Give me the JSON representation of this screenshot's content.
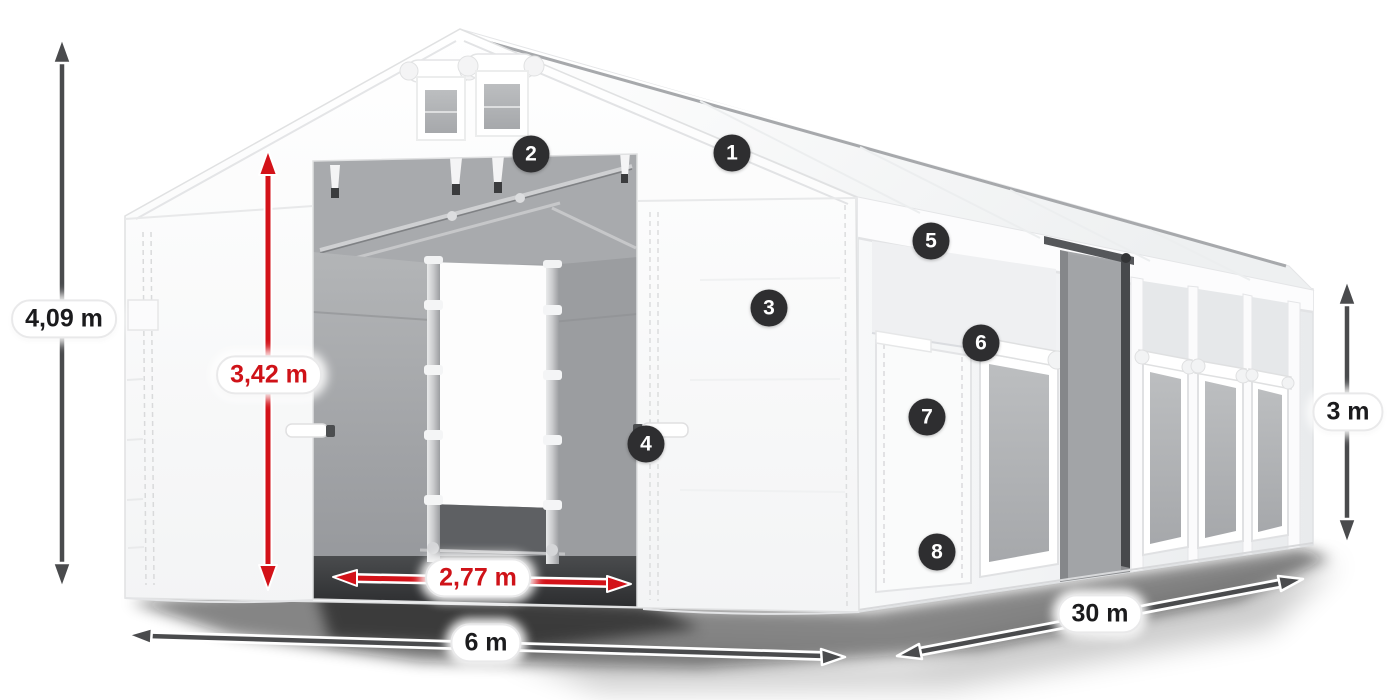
{
  "figure": {
    "kind": "product-dimension-diagram"
  },
  "dimensions": {
    "total_height": "4,09 m",
    "entrance_height": "3,42 m",
    "entrance_width": "2,77 m",
    "front_width": "6 m",
    "side_length": "30 m",
    "side_wall_height": "3 m"
  },
  "hotspots": [
    {
      "label": "1"
    },
    {
      "label": "2"
    },
    {
      "label": "3"
    },
    {
      "label": "4"
    },
    {
      "label": "5"
    },
    {
      "label": "6"
    },
    {
      "label": "7"
    },
    {
      "label": "8"
    }
  ],
  "dimension_arrows": [
    {
      "label": "4,09 m",
      "orientation": "vertical",
      "color": "#4a4b4d"
    },
    {
      "label": "3,42 m",
      "orientation": "vertical",
      "color": "#d31219"
    },
    {
      "label": "2,77 m",
      "orientation": "horizontal",
      "color": "#d31219"
    },
    {
      "label": "6 m",
      "orientation": "horizontal",
      "color": "#4a4b4d"
    },
    {
      "label": "30 m",
      "orientation": "diagonal",
      "color": "#4a4b4d"
    },
    {
      "label": "3 m",
      "orientation": "vertical",
      "color": "#4a4b4d"
    }
  ],
  "colors": {
    "background": "#ffffff",
    "accent_red": "#d31219",
    "arrow_gray": "#4a4b4d",
    "badge_background": "#2e2e30",
    "badge_text": "#ffffff",
    "tent_white": "#ffffff",
    "interior_gray": "#a4a6a9"
  }
}
